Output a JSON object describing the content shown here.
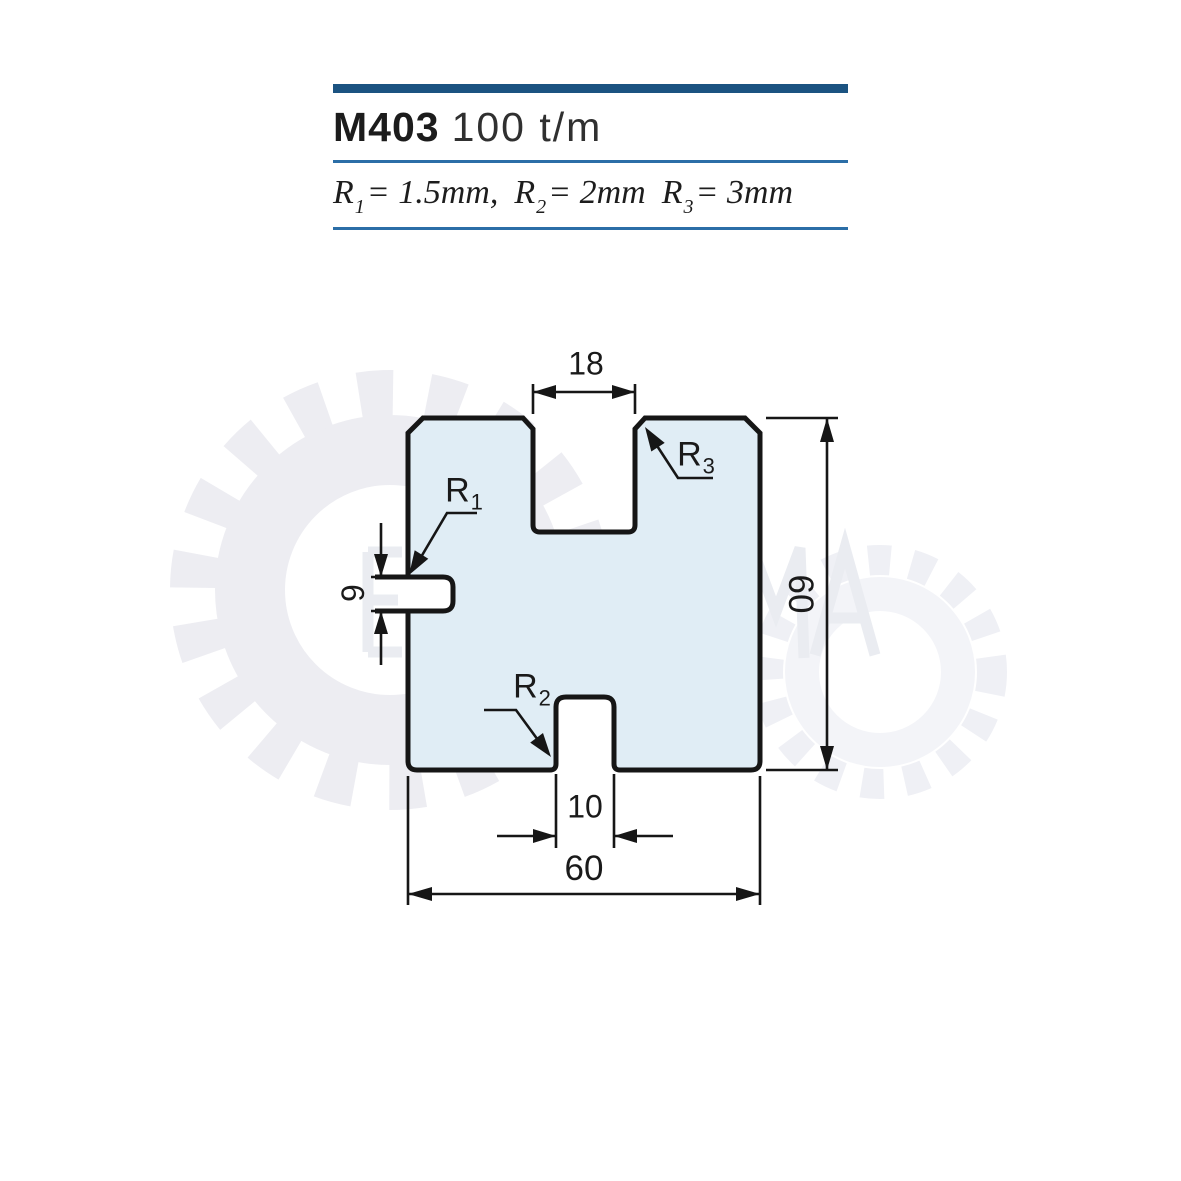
{
  "header": {
    "model": "M403",
    "capacity": "100 t/m",
    "spec": {
      "plain_text": "R1= 1.5mm, R2= 2mm R3= 3mm",
      "parts": [
        {
          "base": "R",
          "sub": "1",
          "value": "= 1.5mm,"
        },
        {
          "base": "R",
          "sub": "2",
          "value": "= 2mm"
        },
        {
          "base": "R",
          "sub": "3",
          "value": "= 3mm"
        }
      ]
    }
  },
  "drawing": {
    "dimensions": {
      "top_slot_width": "18",
      "bottom_slot_width": "10",
      "overall_width": "60",
      "overall_height": "60",
      "side_notch_height": "6"
    },
    "radius_labels": {
      "r1": {
        "base": "R",
        "sub": "1"
      },
      "r2": {
        "base": "R",
        "sub": "2"
      },
      "r3": {
        "base": "R",
        "sub": "3"
      }
    }
  },
  "colors": {
    "accent_bar": "#1b5381",
    "rule_line": "#2b6ea7",
    "shape_fill": "#e0edf5",
    "line_color": "#161616",
    "watermark": "#ededf2"
  }
}
